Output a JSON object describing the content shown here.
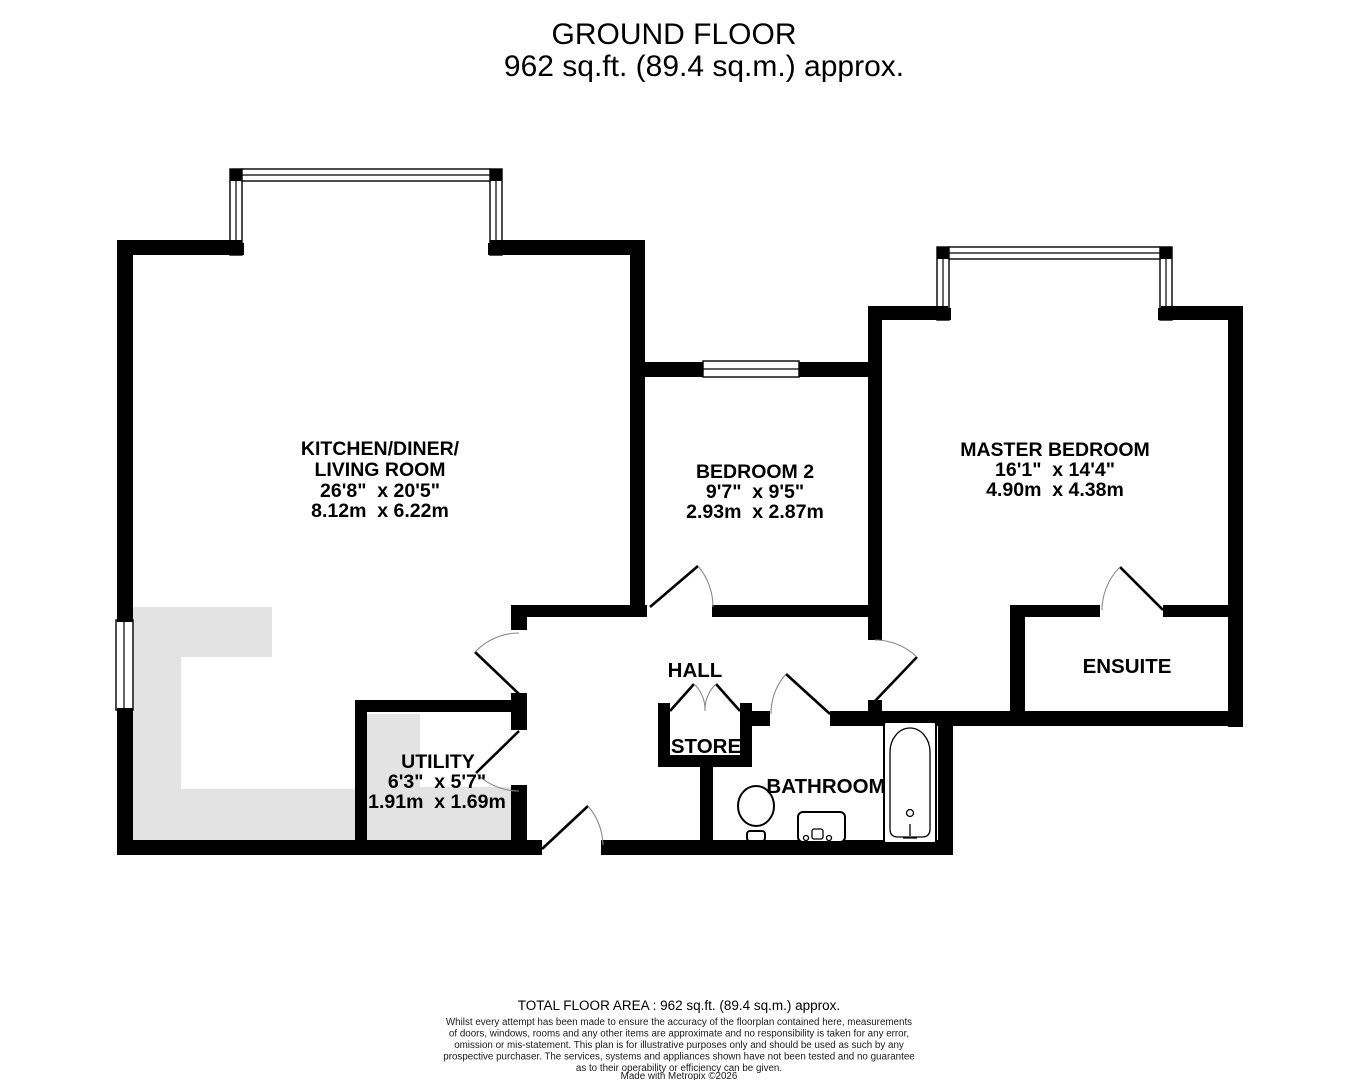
{
  "header": {
    "title": "GROUND FLOOR",
    "subtitle": "962 sq.ft. (89.4 sq.m.) approx."
  },
  "rooms": {
    "kitchen": {
      "name_line1": "KITCHEN/DINER/",
      "name_line2": "LIVING ROOM",
      "dims_imperial": "26'8\"  x 20'5\"",
      "dims_metric": "8.12m  x 6.22m"
    },
    "bedroom2": {
      "name": "BEDROOM 2",
      "dims_imperial": "9'7\"  x 9'5\"",
      "dims_metric": "2.93m  x 2.87m"
    },
    "master_bedroom": {
      "name": "MASTER BEDROOM",
      "dims_imperial": "16'1\"  x 14'4\"",
      "dims_metric": "4.90m  x 4.38m"
    },
    "hall": {
      "name": "HALL"
    },
    "store": {
      "name": "STORE"
    },
    "utility": {
      "name": "UTILITY",
      "dims_imperial": "6'3\"  x 5'7\"",
      "dims_metric": "1.91m  x 1.69m"
    },
    "bathroom": {
      "name": "BATHROOM"
    },
    "ensuite": {
      "name": "ENSUITE"
    }
  },
  "fixtures": [
    "bathtub",
    "toilet",
    "sink"
  ],
  "footer": {
    "total_area": "TOTAL FLOOR AREA : 962 sq.ft. (89.4 sq.m.) approx.",
    "disclaimer_lines": [
      "Whilst every attempt has been made to ensure the accuracy of the floorplan contained here, measurements",
      "of doors, windows, rooms and any other items are approximate and no responsibility is taken for any error,",
      "omission or mis-statement. This plan is for illustrative purposes only and should be used as such by any",
      "prospective purchaser. The services, systems and appliances shown have not been tested and no guarantee",
      "as to their operability or efficiency can be given."
    ],
    "credit": "Made with Metropix ©2026"
  },
  "colors": {
    "wall": "#000000",
    "counter": "#e3e3e3",
    "background": "#ffffff",
    "text": "#000000"
  }
}
